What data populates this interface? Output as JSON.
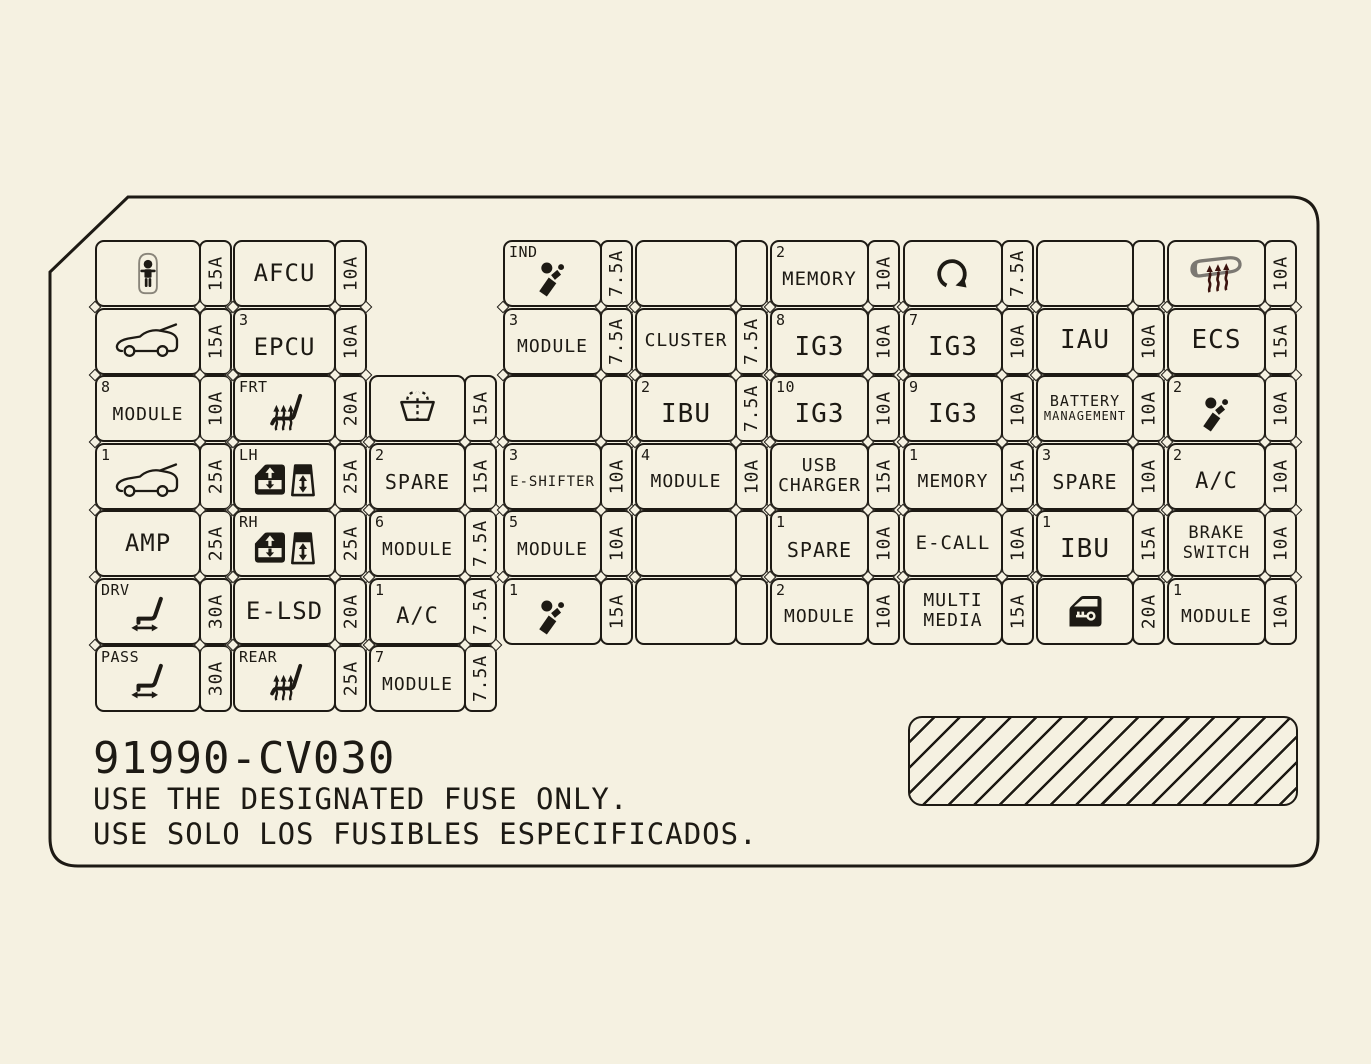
{
  "page": {
    "bg": "#f5f1e1",
    "ink": "#1d1a14",
    "mirror_gray": "#7b7872",
    "mirror_arrow_red": "#3b130e"
  },
  "footer": {
    "part_number": "91990-CV030",
    "notice_en": "USE THE DESIGNATED FUSE ONLY.",
    "notice_es": "USE SOLO LOS FUSIBLES ESPECIFICADOS."
  },
  "grid": {
    "rows": [
      [
        {
          "icon": "child-lock-icon",
          "amp": "15A"
        },
        {
          "label": [
            "AFCU"
          ],
          "amp": "10A",
          "size": 24
        },
        null,
        {
          "prefix": "IND",
          "icon": "airbag-icon",
          "amp": "7.5A"
        },
        {
          "empty": true
        },
        {
          "prefix": "2",
          "label": [
            "MEMORY"
          ],
          "amp": "10A",
          "size": 19
        },
        {
          "icon": "rotation-icon",
          "amp": "7.5A"
        },
        {
          "empty": true
        },
        {
          "icon": "heated-mirror-icon",
          "amp": "10A"
        }
      ],
      [
        {
          "icon": "car-tailgate-icon",
          "amp": "15A"
        },
        {
          "prefix": "3",
          "label": [
            "EPCU"
          ],
          "amp": "10A",
          "size": 24
        },
        null,
        {
          "prefix": "3",
          "label": [
            "MODULE"
          ],
          "amp": "7.5A",
          "size": 18
        },
        {
          "label": [
            "CLUSTER"
          ],
          "amp": "7.5A",
          "size": 18
        },
        {
          "prefix": "8",
          "label": [
            "IG3"
          ],
          "amp": "10A",
          "size": 26
        },
        {
          "prefix": "7",
          "label": [
            "IG3"
          ],
          "amp": "10A",
          "size": 26
        },
        {
          "label": [
            "IAU"
          ],
          "amp": "10A",
          "size": 26
        },
        {
          "label": [
            "ECS"
          ],
          "amp": "15A",
          "size": 26
        }
      ],
      [
        {
          "prefix": "8",
          "label": [
            "MODULE"
          ],
          "amp": "10A",
          "size": 18
        },
        {
          "prefix": "FRT",
          "icon": "heated-seat-icon",
          "amp": "20A"
        },
        {
          "icon": "windshield-washer-icon",
          "amp": "15A"
        },
        {
          "empty": true
        },
        {
          "prefix": "2",
          "label": [
            "IBU"
          ],
          "amp": "7.5A",
          "size": 26
        },
        {
          "prefix": "10",
          "label": [
            "IG3"
          ],
          "amp": "10A",
          "size": 26
        },
        {
          "prefix": "9",
          "label": [
            "IG3"
          ],
          "amp": "10A",
          "size": 26
        },
        {
          "label": [
            "BATTERY",
            "MANAGEMENT"
          ],
          "amp": "10A",
          "size": 15,
          "size2": 12
        },
        {
          "prefix": "2",
          "icon": "airbag-icon",
          "amp": "10A"
        }
      ],
      [
        {
          "prefix": "1",
          "icon": "car-tailgate-icon",
          "amp": "25A"
        },
        {
          "prefix": "LH",
          "icon": "power-window-icon",
          "amp": "25A"
        },
        {
          "prefix": "2",
          "label": [
            "SPARE"
          ],
          "amp": "15A",
          "size": 20
        },
        {
          "prefix": "3",
          "label": [
            "E-SHIFTER"
          ],
          "amp": "10A",
          "size": 14
        },
        {
          "prefix": "4",
          "label": [
            "MODULE"
          ],
          "amp": "10A",
          "size": 18
        },
        {
          "label": [
            "USB",
            "CHARGER"
          ],
          "amp": "15A",
          "size": 18
        },
        {
          "prefix": "1",
          "label": [
            "MEMORY"
          ],
          "amp": "15A",
          "size": 18
        },
        {
          "prefix": "3",
          "label": [
            "SPARE"
          ],
          "amp": "10A",
          "size": 20
        },
        {
          "prefix": "2",
          "label": [
            "A/C"
          ],
          "amp": "10A",
          "size": 22
        }
      ],
      [
        {
          "label": [
            "AMP"
          ],
          "amp": "25A",
          "size": 24
        },
        {
          "prefix": "RH",
          "icon": "power-window-icon",
          "amp": "25A"
        },
        {
          "prefix": "6",
          "label": [
            "MODULE"
          ],
          "amp": "7.5A",
          "size": 18
        },
        {
          "prefix": "5",
          "label": [
            "MODULE"
          ],
          "amp": "10A",
          "size": 18
        },
        {
          "empty": true
        },
        {
          "prefix": "1",
          "label": [
            "SPARE"
          ],
          "amp": "10A",
          "size": 20
        },
        {
          "label": [
            "E-CALL"
          ],
          "amp": "10A",
          "size": 19
        },
        {
          "prefix": "1",
          "label": [
            "IBU"
          ],
          "amp": "15A",
          "size": 26
        },
        {
          "label": [
            "BRAKE",
            "SWITCH"
          ],
          "amp": "10A",
          "size": 17
        }
      ],
      [
        {
          "prefix": "DRV",
          "icon": "power-seat-icon",
          "amp": "30A"
        },
        {
          "label": [
            "E-LSD"
          ],
          "amp": "20A",
          "size": 24
        },
        {
          "prefix": "1",
          "label": [
            "A/C"
          ],
          "amp": "7.5A",
          "size": 22
        },
        {
          "prefix": "1",
          "icon": "airbag-icon",
          "amp": "15A"
        },
        {
          "empty": true
        },
        {
          "prefix": "2",
          "label": [
            "MODULE"
          ],
          "amp": "10A",
          "size": 18
        },
        {
          "label": [
            "MULTI",
            "MEDIA"
          ],
          "amp": "15A",
          "size": 18
        },
        {
          "icon": "door-key-icon",
          "amp": "20A"
        },
        {
          "prefix": "1",
          "label": [
            "MODULE"
          ],
          "amp": "10A",
          "size": 18
        }
      ],
      [
        {
          "prefix": "PASS",
          "icon": "power-seat-icon",
          "amp": "30A"
        },
        {
          "prefix": "REAR",
          "icon": "heated-seat-icon",
          "amp": "25A"
        },
        {
          "prefix": "7",
          "label": [
            "MODULE"
          ],
          "amp": "7.5A",
          "size": 18
        },
        null,
        null,
        null,
        null,
        null,
        null
      ]
    ]
  }
}
